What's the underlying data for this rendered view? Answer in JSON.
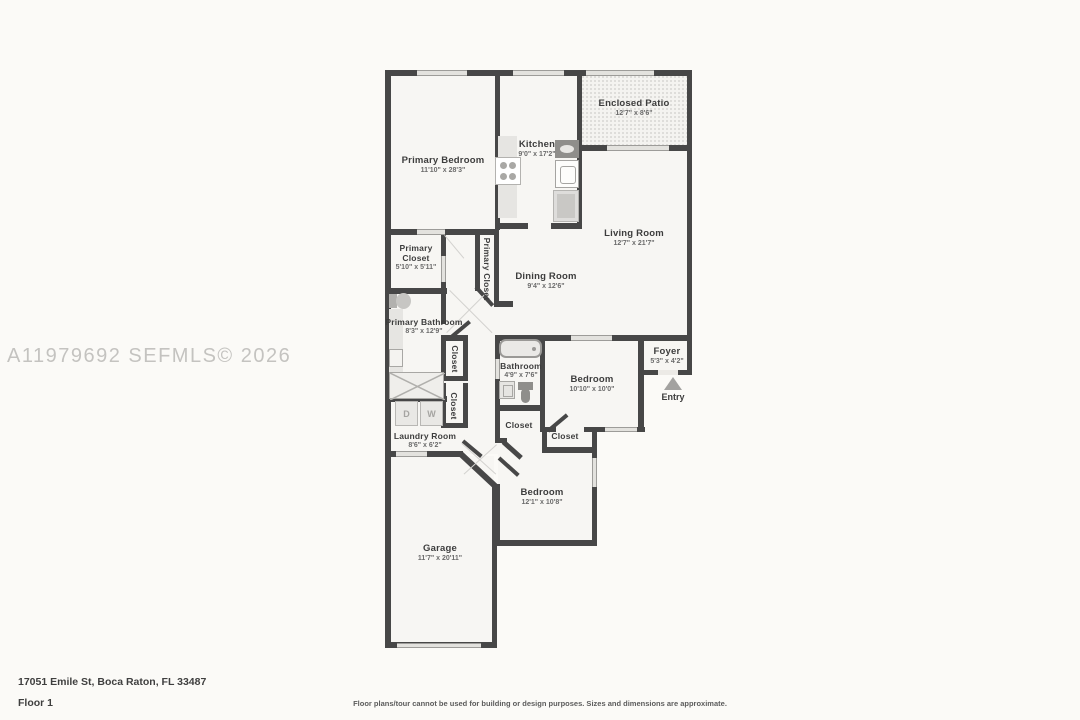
{
  "watermark": "A11979692 SEFMLS© 2026",
  "footer": {
    "address": "17051 Emile St, Boca Raton, FL 33487",
    "floor_label": "Floor 1",
    "disclaimer": "Floor plans/tour cannot be used for building or design purposes. Sizes and dimensions are approximate."
  },
  "labels": {
    "entry": "Entry"
  },
  "fixtures": {
    "dryer_label": "D",
    "washer_label": "W"
  },
  "colors": {
    "wall": "#474747",
    "background": "#fbfaf7",
    "room_fill": "#f7f6f3",
    "window": "#e3e2de",
    "watermark": "#c4c3c0",
    "entry_arrow": "#a3a2a0"
  },
  "rooms": {
    "primary_bedroom": {
      "name": "Primary Bedroom",
      "dims": "11'10\" x 28'3\""
    },
    "kitchen": {
      "name": "Kitchen",
      "dims": "9'0\" x 17'2\""
    },
    "enclosed_patio": {
      "name": "Enclosed Patio",
      "dims": "12'7\" x 8'6\""
    },
    "living_room": {
      "name": "Living Room",
      "dims": "12'7\" x 21'7\""
    },
    "primary_closet": {
      "name": "Primary Closet",
      "dims": "5'10\" x 5'11\""
    },
    "primary_closet_hall": {
      "name": "Primary Closet"
    },
    "dining_room": {
      "name": "Dining Room",
      "dims": "9'4\" x 12'6\""
    },
    "primary_bathroom": {
      "name": "Primary Bathroom",
      "dims": "8'3\" x 12'9\""
    },
    "closet_hall_upper": {
      "name": "Closet"
    },
    "closet_hall_lower": {
      "name": "Closet"
    },
    "bathroom": {
      "name": "Bathroom",
      "dims": "4'9\" x 7'6\""
    },
    "bedroom_1": {
      "name": "Bedroom",
      "dims": "10'10\" x 10'0\""
    },
    "foyer": {
      "name": "Foyer",
      "dims": "5'3\" x 4'2\""
    },
    "laundry_room": {
      "name": "Laundry Room",
      "dims": "8'6\" x 6'2\""
    },
    "closet_1": {
      "name": "Closet"
    },
    "closet_2": {
      "name": "Closet"
    },
    "bedroom_2": {
      "name": "Bedroom",
      "dims": "12'1\" x 10'8\""
    },
    "garage": {
      "name": "Garage",
      "dims": "11'7\" x 20'11\""
    }
  }
}
